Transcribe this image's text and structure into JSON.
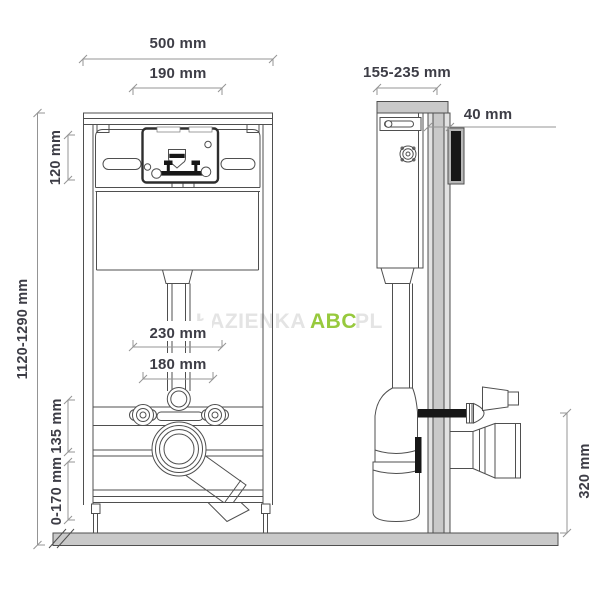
{
  "labels": {
    "front": {
      "total_width": "500 mm",
      "window_width": "190 mm",
      "cistern_height": "120 mm",
      "frame_height": "1120-1290 mm",
      "spacing_outer": "230 mm",
      "spacing_inner": "180 mm",
      "drain_offset": "135 mm",
      "floor_adjust": "0-170 mm"
    },
    "side": {
      "depth_range": "155-235 mm",
      "profile_depth": "40 mm",
      "outlet_height": "320 mm"
    }
  },
  "watermark": {
    "prefix": "ŁAZIENKA",
    "brand": "ABC",
    "suffix": "PL"
  },
  "colors": {
    "accent_green": "#97c93d",
    "line": "#4f4f4f",
    "dim_line": "#949494",
    "fill_gray": "#c9c9c9",
    "black_parts": "#171717",
    "text": "#3d3d46",
    "watermark_faint": "#e4e4e4"
  }
}
